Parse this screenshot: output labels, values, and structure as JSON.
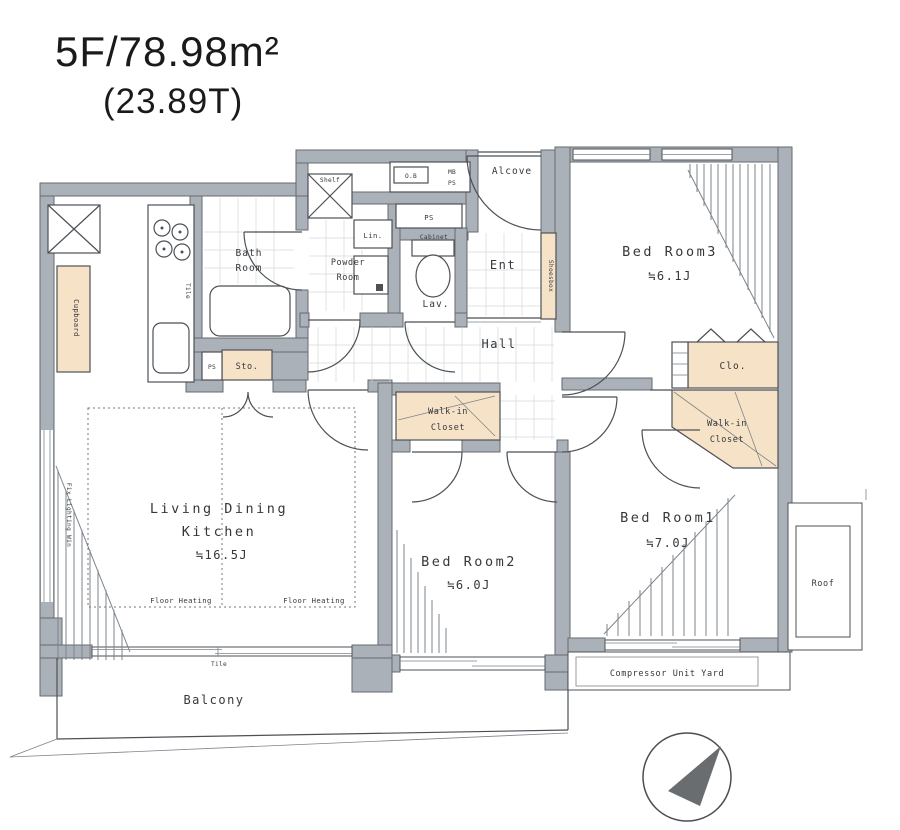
{
  "header": {
    "title": "5F/78.98m²",
    "subtitle": "(23.89T)"
  },
  "rooms": {
    "bedroom3": {
      "name": "Bed Room3",
      "size": "≒6.1J"
    },
    "bedroom2": {
      "name": "Bed Room2",
      "size": "≒6.0J"
    },
    "bedroom1": {
      "name": "Bed Room1",
      "size": "≒7.0J"
    },
    "ldk": {
      "name_line1": "Living Dining",
      "name_line2": "Kitchen",
      "size": "≒16.5J"
    },
    "bath": {
      "line1": "Bath",
      "line2": "Room"
    },
    "powder": {
      "line1": "Powder",
      "line2": "Room"
    },
    "lav": "Lav.",
    "ent": "Ent",
    "hall": "Hall",
    "alcove": "Alcove",
    "balcony": "Balcony",
    "roof": "Roof",
    "compressor_yard": "Compressor Unit Yard"
  },
  "storage": {
    "cupboard": "Cupboard",
    "shoesbox": "Shoesbox",
    "sto": "Sto.",
    "lin": "Lin.",
    "shelf": "Shelf",
    "cabinet": "Cabinet",
    "clo": "Clo.",
    "wic_left": {
      "line1": "Walk-in",
      "line2": "Closet"
    },
    "wic_right": {
      "line1": "Walk-in",
      "line2": "Closet"
    }
  },
  "small_labels": {
    "mb": "MB",
    "ps_top": "PS",
    "ps_box": "PS",
    "ps_sto": "PS",
    "ob": "O.B",
    "tile_kitchen": "Tile",
    "tile_balcony": "Tile",
    "floor_heating_left": "Floor Heating",
    "floor_heating_right": "Floor Heating",
    "side_window_note": "Fix Lighting Win"
  },
  "colors": {
    "wall": "#aab1b8",
    "closet": "#f6e3c7",
    "line": "#4c5156",
    "text": "#34383c",
    "compass_needle": "#6a6d70"
  }
}
